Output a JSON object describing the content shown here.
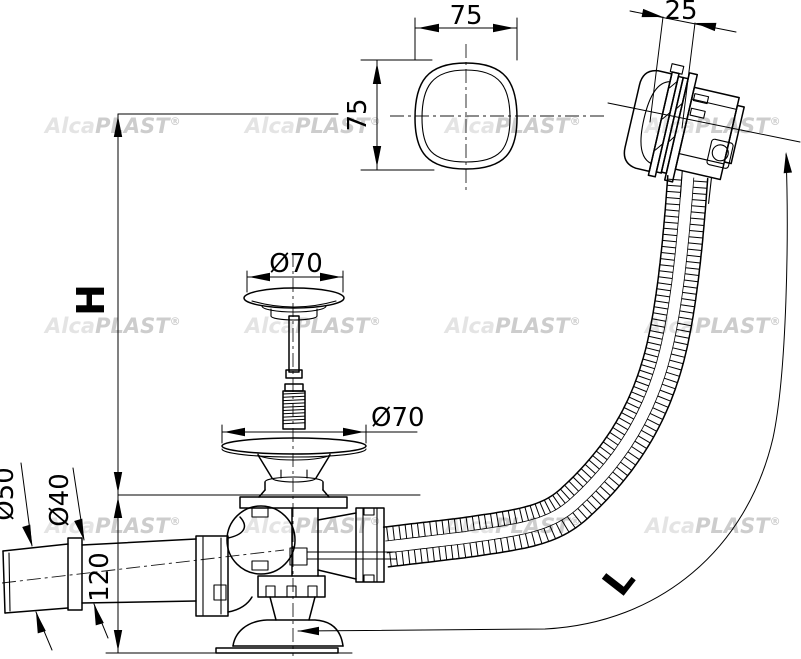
{
  "drawing": {
    "brand": {
      "alca": "Alca",
      "plast": "PLAST",
      "reg": "®"
    },
    "dimensions": {
      "cover_width": "75",
      "cover_height": "75",
      "overflow_cap_depth": "25",
      "plug_cap_diameter": "Ø70",
      "strainer_diameter": "Ø70",
      "outlet_outer_diameter": "Ø50",
      "outlet_inner_diameter": "Ø40",
      "drain_body_height": "120",
      "install_height_label": "H",
      "hose_length_label": "L"
    }
  }
}
